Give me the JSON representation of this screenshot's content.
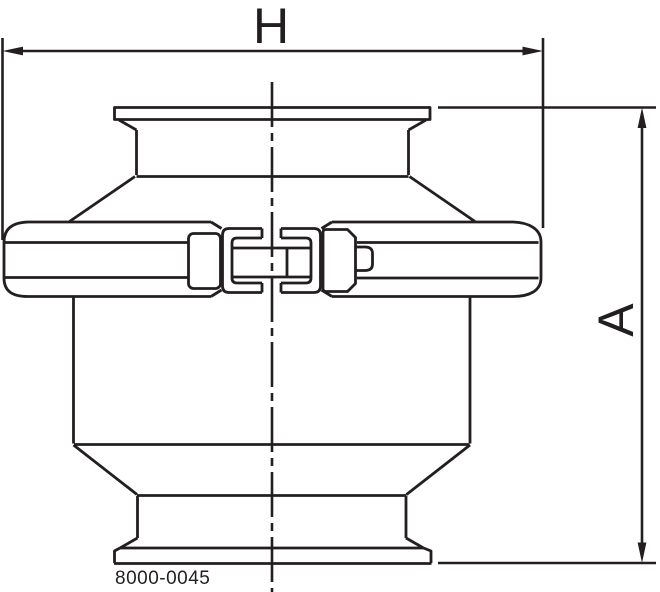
{
  "drawing": {
    "dimensions": {
      "horizontal": {
        "label": "H"
      },
      "vertical": {
        "label": "A"
      }
    },
    "part_number": "8000-0045",
    "icons": {
      "arrow_left": "dimension-arrowhead-left",
      "arrow_right": "dimension-arrowhead-right",
      "arrow_up": "dimension-arrowhead-up",
      "arrow_down": "dimension-arrowhead-down"
    }
  },
  "colors": {
    "line": "#231f20",
    "background": "#ffffff"
  }
}
